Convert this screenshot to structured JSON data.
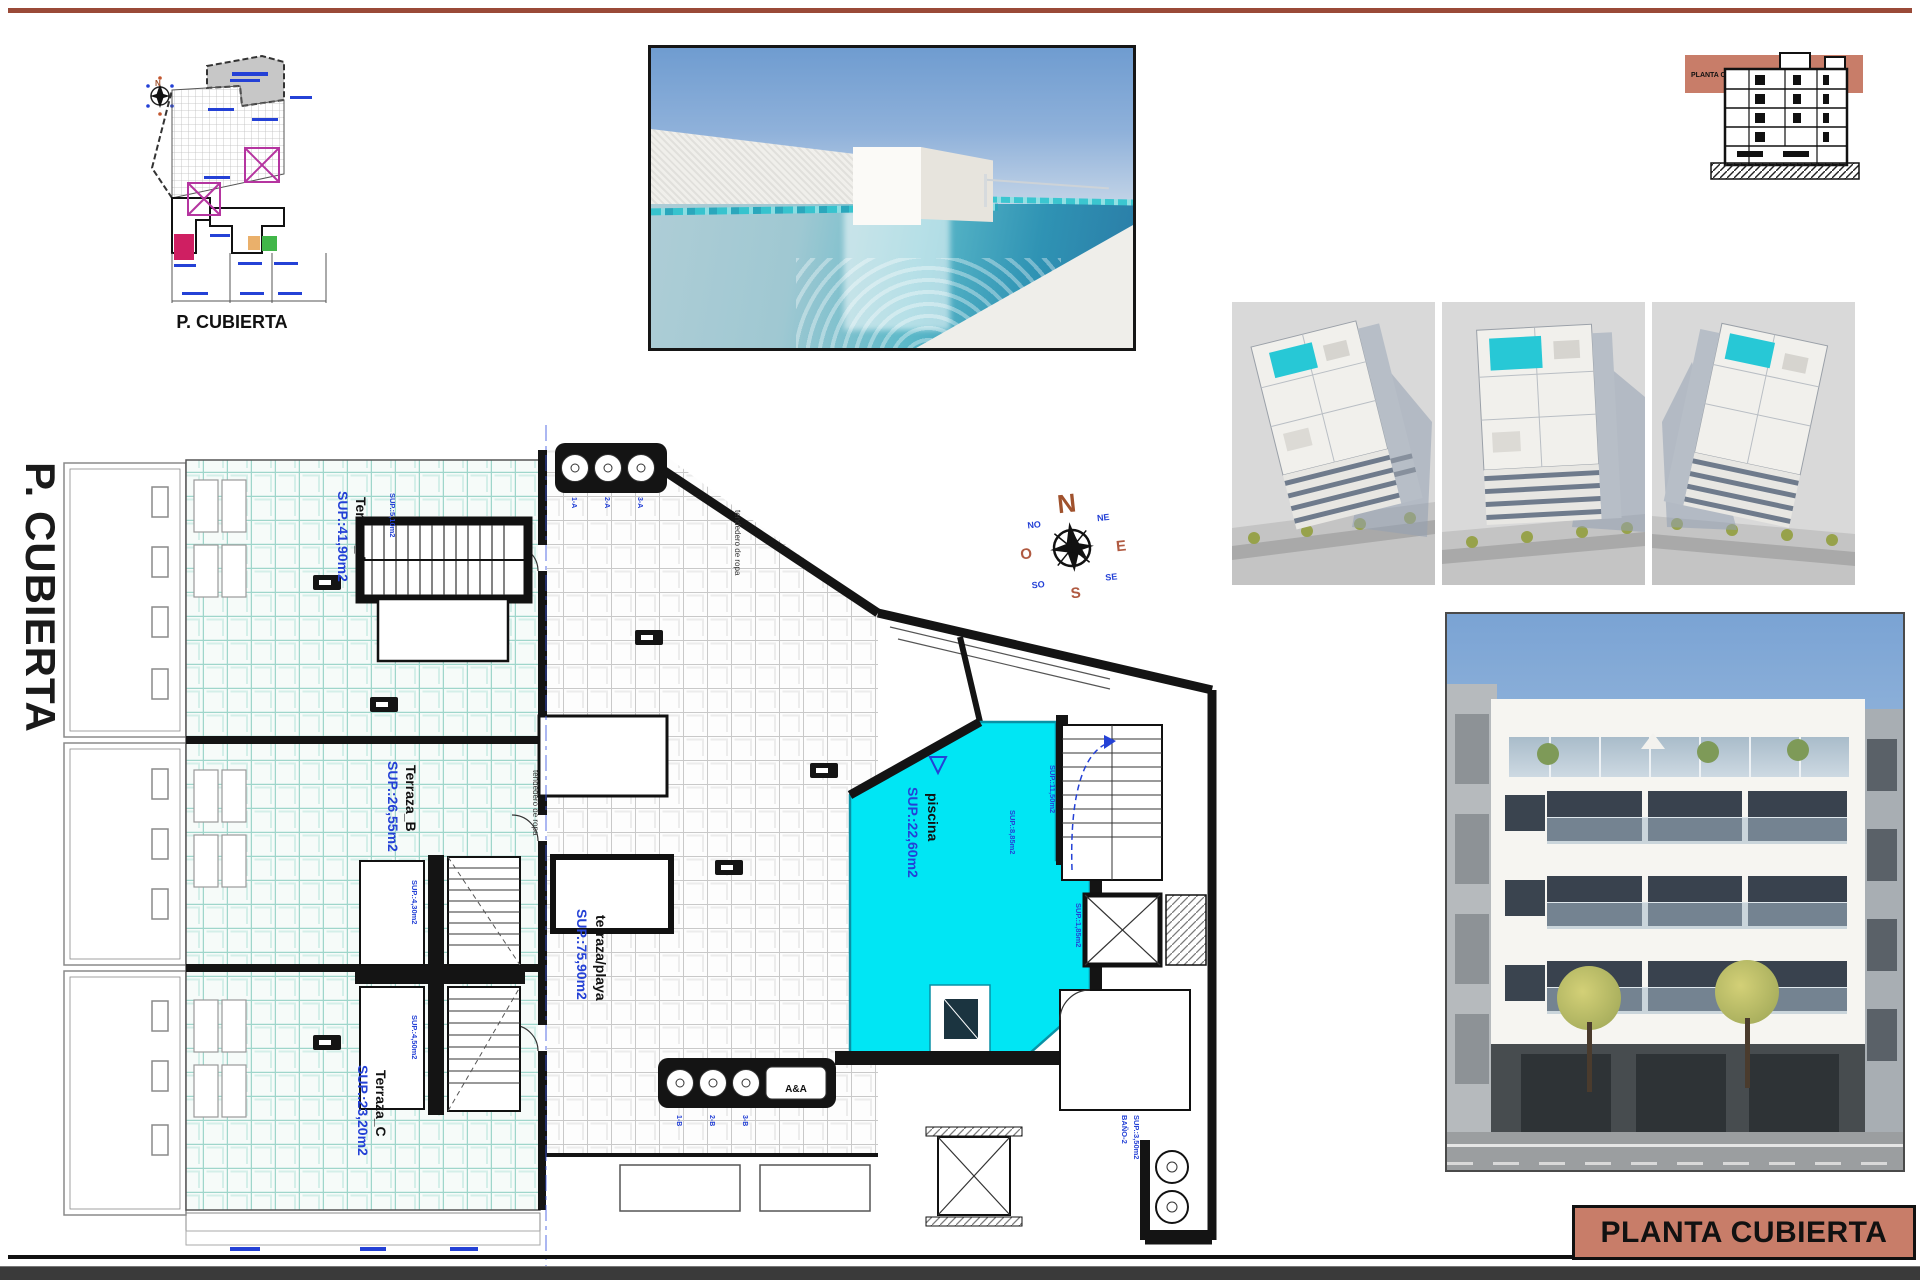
{
  "sheet": {
    "left_title": "P. CUBIERTA",
    "bottom_title": "PLANTA CUBIERTA"
  },
  "site_plan": {
    "caption": "P. CUBIERTA"
  },
  "section": {
    "band_label": "PLANTA CUBIERTA"
  },
  "compass": {
    "n": "N",
    "s": "S",
    "e": "E",
    "w": "O",
    "ne": "NE",
    "nw": "NO",
    "se": "SE",
    "sw": "SO"
  },
  "plan": {
    "terraza_a_name": "Terraza_A",
    "terraza_a_sup": "SUP.:41,90m2",
    "terraza_b_name": "Terraza_B",
    "terraza_b_sup": "SUP.:26,55m2",
    "terraza_c_name": "Terraza_C",
    "terraza_c_sup": "SUP.:23,20m2",
    "playa_name": "terraza/playa",
    "playa_sup": "SUP.:75,90m2",
    "piscina_name": "piscina",
    "piscina_sup": "SUP.:22,60m2",
    "tendedero_a": "tendedero de ropa",
    "tendedero_b": "tendedero de ropa",
    "sup_stair_top": "SUP.:5,10m2",
    "sup_core_up": "SUP.:4,30m2",
    "sup_core_down": "SUP.:4,50m2",
    "sup_right_stair": "SUP.:11,50m2",
    "sup_pool_side": "SUP.:8,85m2",
    "sup_lift": "SUP.:1,85m2",
    "bano_name": "BAÑO-2",
    "bano_sup": "SUP.:3,50m2",
    "top_circles": [
      "1-A",
      "2-A",
      "3-A"
    ],
    "bottom_circles": [
      "1-B",
      "2-B",
      "3-B"
    ],
    "lift_box": "A&A"
  },
  "colors": {
    "accent_rule": "#9a4a38",
    "title_block_bg": "#c87d69",
    "pool_cyan": "#00e6f4",
    "label_blue": "#2441d6",
    "terrace_teal": "#9fd6cb"
  }
}
